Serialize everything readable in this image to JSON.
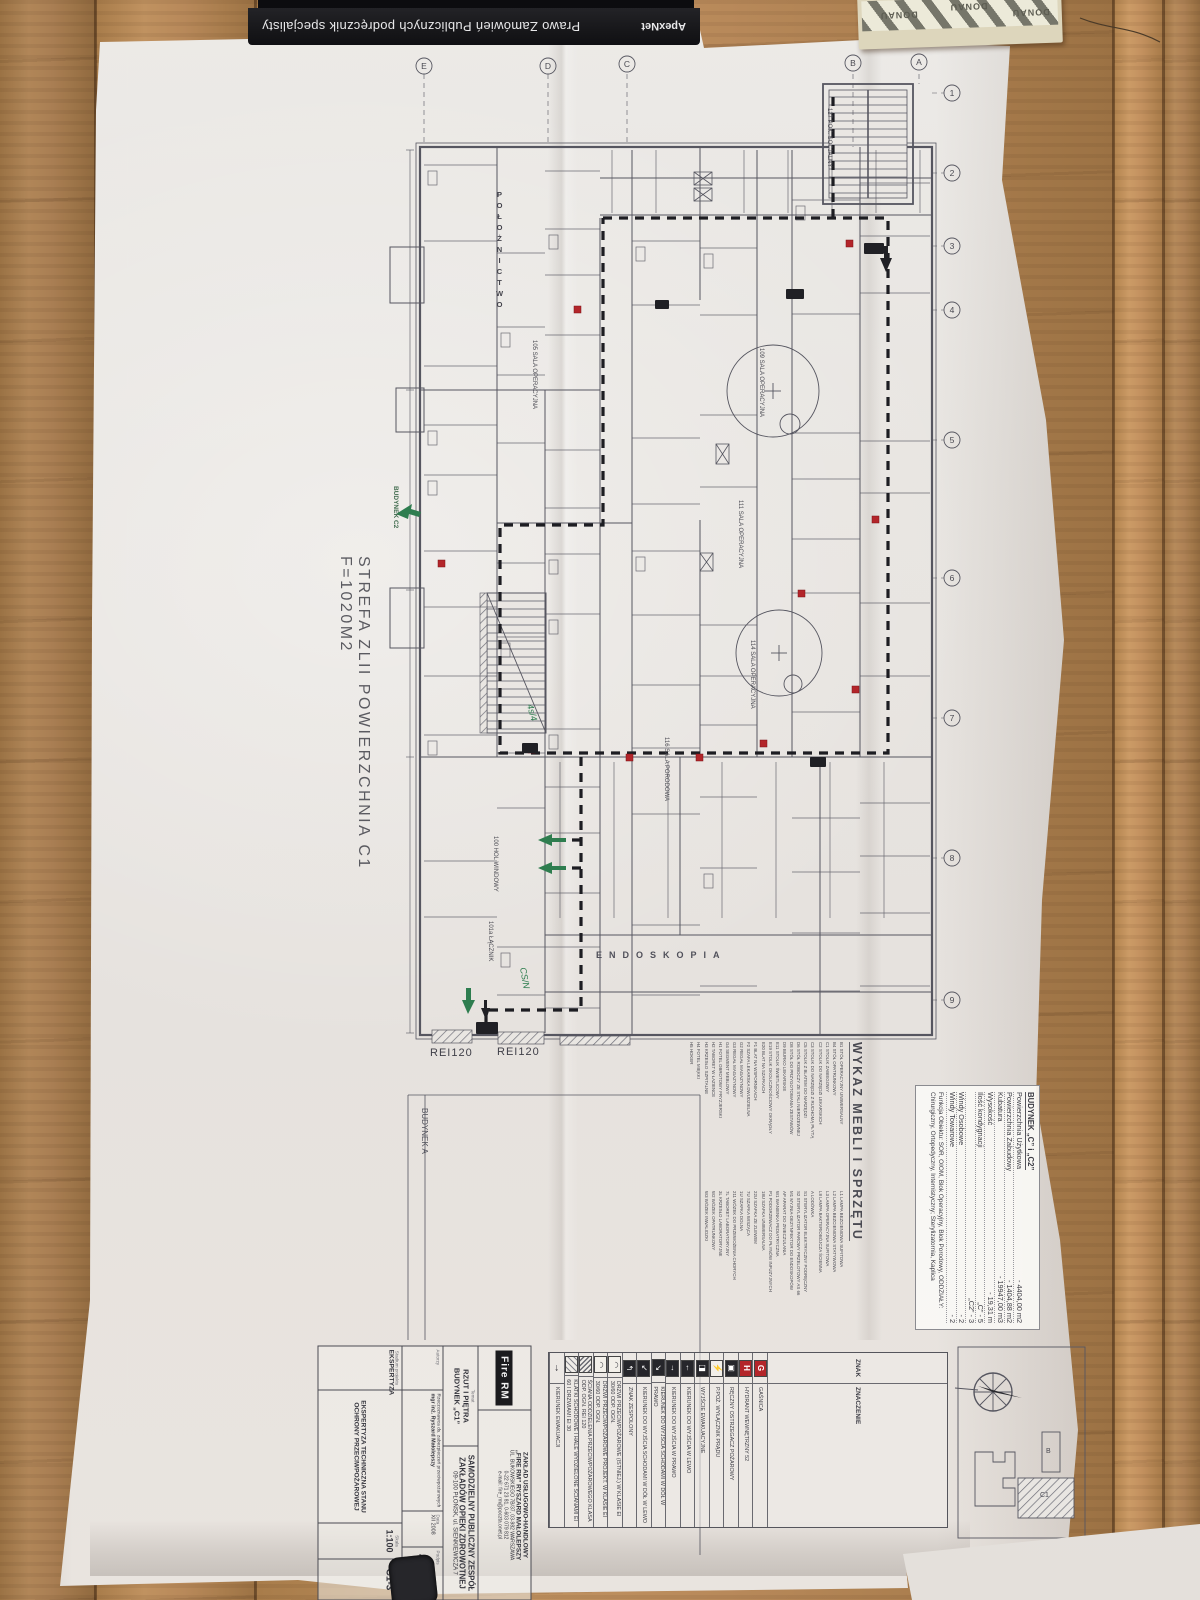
{
  "books": {
    "spine_title": "Prawo Zamówień Publicznych podręcznik specjalisty",
    "spine_brand": "ApexNet",
    "pad_brand": "DONAU"
  },
  "plan": {
    "zone_label": "STREFA  ZLII  POWIERZCHNIA  C1  F=1020M2",
    "dept_top": "POŁOŻNICTWO",
    "dept_bottom": "ENDOSKOPIA",
    "rei_label_1": "REI120",
    "rei_label_2": "REI120",
    "building_a": "BUDYNEK A",
    "building_c2": "BUDYNEK C2",
    "note_green_1": "4s/4",
    "note_green_2": "CS/N",
    "grid_numbers": [
      "1",
      "2",
      "3",
      "4",
      "5",
      "6",
      "7",
      "8",
      "9"
    ],
    "grid_letters": [
      "E",
      "D",
      "C",
      "B",
      "A"
    ],
    "rooms": [
      "105 SALA OPERACYJNA",
      "109 SALA OPERACYJNA",
      "111 SALA OPERACYJNA",
      "114 SALA OPERACYJNA",
      "116 SALA PORODOWA",
      "100 HOL WINDOWY",
      "101a ŁĄCZNIK",
      "127 POK. SOCJALNY"
    ]
  },
  "info_table": {
    "title": "BUDYNEK „C” i „C2”",
    "rows": [
      {
        "l": "Powierzchnia Użytkowa",
        "v": "- 4404,00 m2"
      },
      {
        "l": "Powierzchnia Zabudowy",
        "v": "- 1404,88 m2"
      },
      {
        "l": "Kubatura",
        "v": "- 19947,00 m3"
      },
      {
        "l": "Wysokość",
        "v": "- 19,31 m"
      },
      {
        "l": "Ilość kondygnacji",
        "v": "„C” - 5"
      },
      {
        "l": "",
        "v": "„C2” - 3"
      },
      {
        "l": "Windy Osobowe",
        "v": "- 2"
      },
      {
        "l": "Windy Towarowe",
        "v": "- 2"
      }
    ],
    "function_line": "Funkcja Obiektu: SOR, OIOM, Blok Operacyjny, Blok Porodowy, ODDZIAŁY: Chirurgiczny, Ortopedyczny, Internistyczny; Sterylizatornia, Kaplica"
  },
  "furniture": {
    "title": "WYKAZ MEBLI I SPRZĘTU",
    "col1": [
      "B1  STÓŁ OPERACYJNY UNIWERSALNY",
      "B4  STÓŁ OPATRUNKOWY",
      "C1  STOLIK ZABIEGOWY",
      "C2  STOLIK DO NARZĘDZI LEKARSKICH",
      "C3  STOLIK DO NARZĘDZI Z RUCHOMĄ PŁYTĄ",
      "C5  STOLIK Z BLATEM DO NARZĘDZI",
      "D6  STÓŁ ROBOCZY ZE STALI NIERDZEWNEJ",
      "D8  STÓŁ DO PRZYGOTOWANIA ZESTAWÓW",
      "D9  BIURKO LEKARSKIE",
      "E11 STOLIK ŚWIETLICOWY",
      "E19 STOLIK OKOLICZNOŚCIOWY OKRĄGŁY",
      "E20 BLAT NA SZAFKACH",
      "F1  BLAT NA WSPORNIKACH",
      "F2  SZAFA LEKARSKA DWUDZIELNA",
      "G2  REGAŁ MAGAZYNOWY",
      "G3  REGAŁ MAGAZYNOWY",
      "G4  SEGMENT MEBLOWY",
      "H1  FOTEL OBROTOWY FRYZJERSKI",
      "H2  TABORET W ŁAZIENCE",
      "H3  KRZESŁO SZPITALNE",
      "H4  FOTEL MIĘKKI",
      "H5  HOKER"
    ],
    "col2": [
      "L1  LAMPA BEZCIENIOWA SUFITOWA",
      "L2  LAMPA BEZCIENIOWA STATYWOWA",
      "L3  LAMPA OPERACYJNA SUFITOWA",
      "L8  LAMPA BAKTERIOBÓJCZA ŚCIENNA",
      "A   LODÓWKA",
      "S1  STERYLIZATOR ELEKTRYCZNY PODRĘCZNY",
      "S2  STERYLIZATOR PAROWY PRZELOTOWY AS 66",
      "M1  MYJNIA-DEZYNFEKTOR DO ENDOSKOPÓW",
      "AP  APARAT DO ZNIECZULANIA",
      "W1  WANIENKA PEDIATRYCZNA",
      "P1  PODGRZEWACZ DO PŁYNÓW INFUZYJNYCH",
      "18U SZAFKA UNIWERSALNA",
      "22U SZAFKA ZE ZLEWEM",
      "7U  SZAFKA WISZĄCA",
      "1U  SZAFKA DOLNA",
      "211 WÓZEK DO PRZEWOŻENIA CHORYCH",
      "7L  TABORET LABORATORYJNY",
      "3L  KRZESŁO LABORATORYJNE",
      "W2  WÓZEK OPATRUNKOWY",
      "W3  WÓZEK INWALIDZKI"
    ]
  },
  "legend": {
    "header_sign": "ZNAK",
    "header_meaning": "ZNACZENIE",
    "rows": [
      {
        "glyph": "G",
        "icon": "ic-red",
        "label": "GAŚNICA"
      },
      {
        "glyph": "H",
        "icon": "ic-red",
        "label": "HYDRANT WEWNĘTRZNY 52"
      },
      {
        "glyph": "▣",
        "icon": "ic-dark",
        "label": "RĘCZNY OSTRZEGACZ POŻAROWY"
      },
      {
        "glyph": "⚡",
        "icon": "ic-flash",
        "label": "P.POŻ. WYŁĄCZNIK PRĄDU"
      },
      {
        "glyph": "◨",
        "icon": "ic-dark",
        "label": "WYJŚCIE EWAKUACYJNE"
      },
      {
        "glyph": "←",
        "icon": "ic-dark",
        "label": "KIERUNEK DO WYJŚCIA W LEWO"
      },
      {
        "glyph": "→",
        "icon": "ic-dark",
        "label": "KIERUNEK DO WYJŚCIA W PRAWO"
      },
      {
        "glyph": "↘",
        "icon": "ic-dark",
        "label": "KIERUNEK DO WYJŚCIA SCHODAMI W DÓŁ W PRAWO"
      },
      {
        "glyph": "↙",
        "icon": "ic-dark",
        "label": "KIERUNEK DO WYJŚCIA SCHODAMI W DÓŁ W LEWO"
      },
      {
        "glyph": "↰",
        "icon": "ic-dark",
        "label": "ZNAK ZESPOLONY"
      },
      {
        "glyph": "◠",
        "icon": "ic-door",
        "label": "DRZWI PRZECIWPOŻAROWE (ISTNIEJ.) W KLASIE EI 30/60 ODP. OGN."
      },
      {
        "glyph": "◠",
        "icon": "ic-door",
        "label": "DRZWI PRZECIWPOŻAROWE PROJEKT. W KLASIE EI 30/60 ODP. OGN."
      },
      {
        "glyph": "▨",
        "icon": "ic-hatch",
        "label": "ŚCIANA ODDZIELENIA PRZECIWPOŻAROWEGO KLASA ODP. OGN. REI 120"
      },
      {
        "glyph": "▨",
        "icon": "ic-hatch2",
        "label": "KLATKI SCHODOWE I HALE WYDZIELONE ŚCIANAMI EI 60 I DRZWIAMI EI 30"
      },
      {
        "glyph": "→",
        "icon": "ic-plain",
        "label": "KIERUNEK EWAKUACJI"
      }
    ]
  },
  "title_block": {
    "logo": "Fire RM",
    "company1": "ZAKŁAD USŁUGOWO-HANDLOWY",
    "company2": "„FIRE RM” RYSZARD MAŁOLEPSZY",
    "addr1": "UL. BUKOWSKIEGO 7B/37, 03-982 WARSZAWA",
    "addr2": "0-22 671 23 81, 0-603 079 812",
    "addr3": "e-mail: fire_rm@poczta.onet.pl",
    "subject_label": "Temat",
    "subject1": "RZUT I PIĘTRA",
    "subject2": "BUDYNEK „C1”",
    "investor1": "SAMODZIELNY PUBLICZNY ZESPÓŁ",
    "investor2": "ZAKŁADÓW OPIEKI ZDROWOTNEJ",
    "investor3": "09-100 PŁOŃSK, ul. SIENKIEWICZA 7",
    "authors_label": "Autorzy",
    "author_role": "Rzeczoznawca ds. zabezpieczeń przeciwpożarowych",
    "author_name": "mgr inż. Ryszard Małolepszy",
    "date_label": "Data",
    "date": "XII 2008",
    "podpis_label": "Podpis",
    "stage_label": "Stadium projektu",
    "stage": "EKSPERTYZA",
    "doc_title": "EKSPERTYZA TECHNICZNA STANU OCHRONY PRZECIWPOŻAROWEJ",
    "scale_label": "Skala",
    "scale": "1:100",
    "no_label": "Nr rys.",
    "no": "C1-3"
  },
  "site_inset": {
    "label_b": "B",
    "label_c1": "C1"
  },
  "colors": {
    "marker_red": "#b3252a",
    "evac_green": "#2e7d4f",
    "print": "#4a4a52"
  }
}
